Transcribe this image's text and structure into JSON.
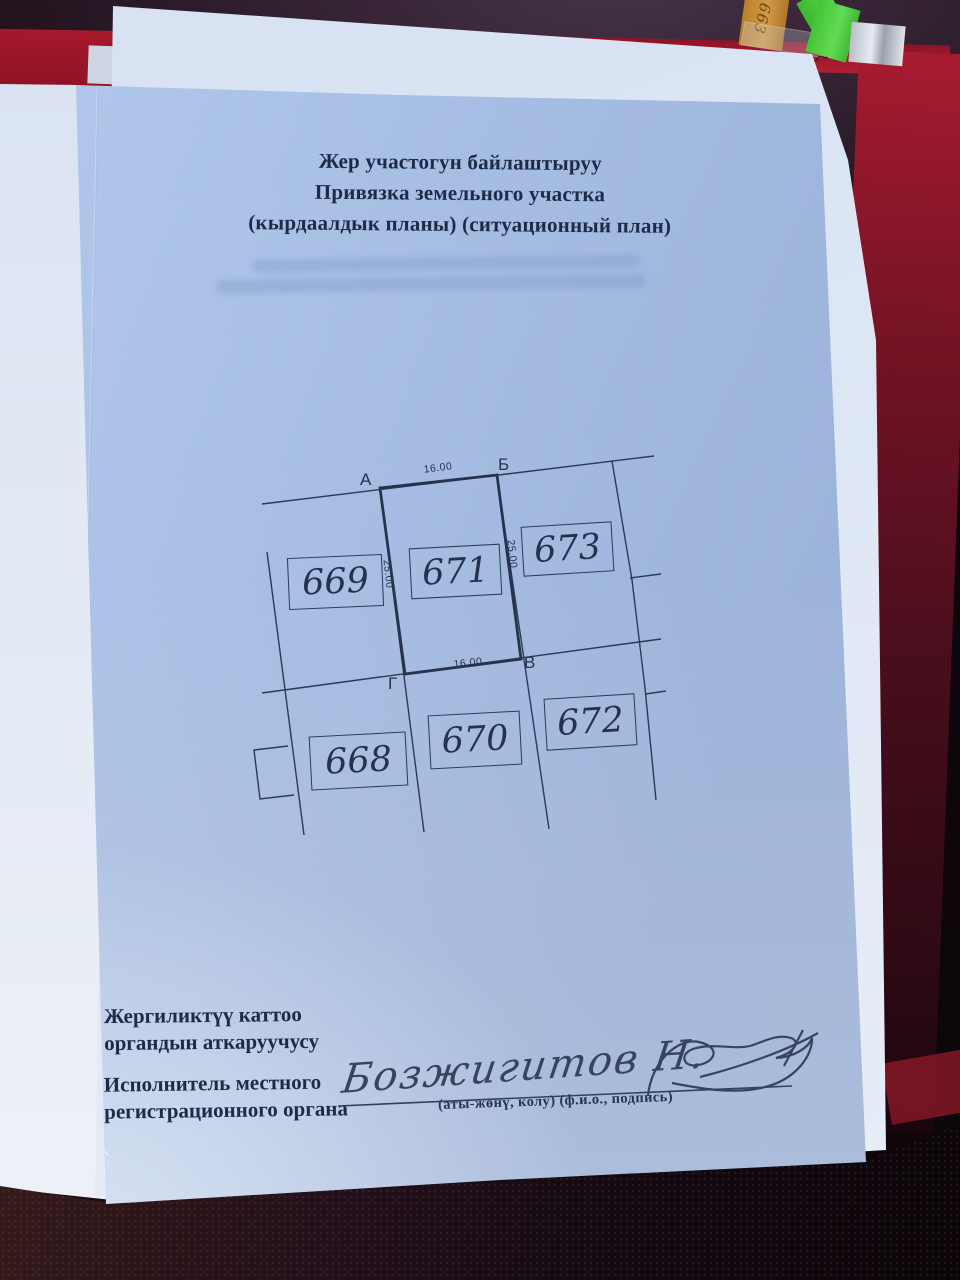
{
  "document": {
    "title_lines": [
      "Жер участогун байлаштыруу",
      "Привязка земельного участка",
      "(кырдаалдык планы) (ситуационный план)"
    ],
    "diagram": {
      "parcels": [
        {
          "number": "669"
        },
        {
          "number": "671"
        },
        {
          "number": "673"
        },
        {
          "number": "668"
        },
        {
          "number": "670"
        },
        {
          "number": "672"
        }
      ],
      "corners": {
        "a": "А",
        "b": "Б",
        "v": "В",
        "g": "Г"
      },
      "dims": {
        "top": "16.00",
        "left": "25.00",
        "right": "25.00",
        "bottom": "16.00"
      }
    },
    "footer": {
      "label_ky_line1": "Жергиликтүү каттоо",
      "label_ky_line2": "органдын аткаруучусу",
      "label_ru_line1": "Исполнитель местного",
      "label_ru_line2": "регистрационного органа",
      "signature_name": "Бозжигитов Н.",
      "signature_caption": "(аты-жөнү, колу)  (ф.и.о., подпись)"
    }
  },
  "environment": {
    "sticky_tab_text": "663"
  },
  "colors": {
    "page_blue": "#abc3ea",
    "sheet_white": "#dde6f5",
    "folder_red": "#b01e33",
    "ink": "#1e2a47",
    "drawing_ink": "#2b3a55",
    "tab_green": "#46c838",
    "tab_orange": "#c08433",
    "leather_dark": "#2a1216"
  }
}
